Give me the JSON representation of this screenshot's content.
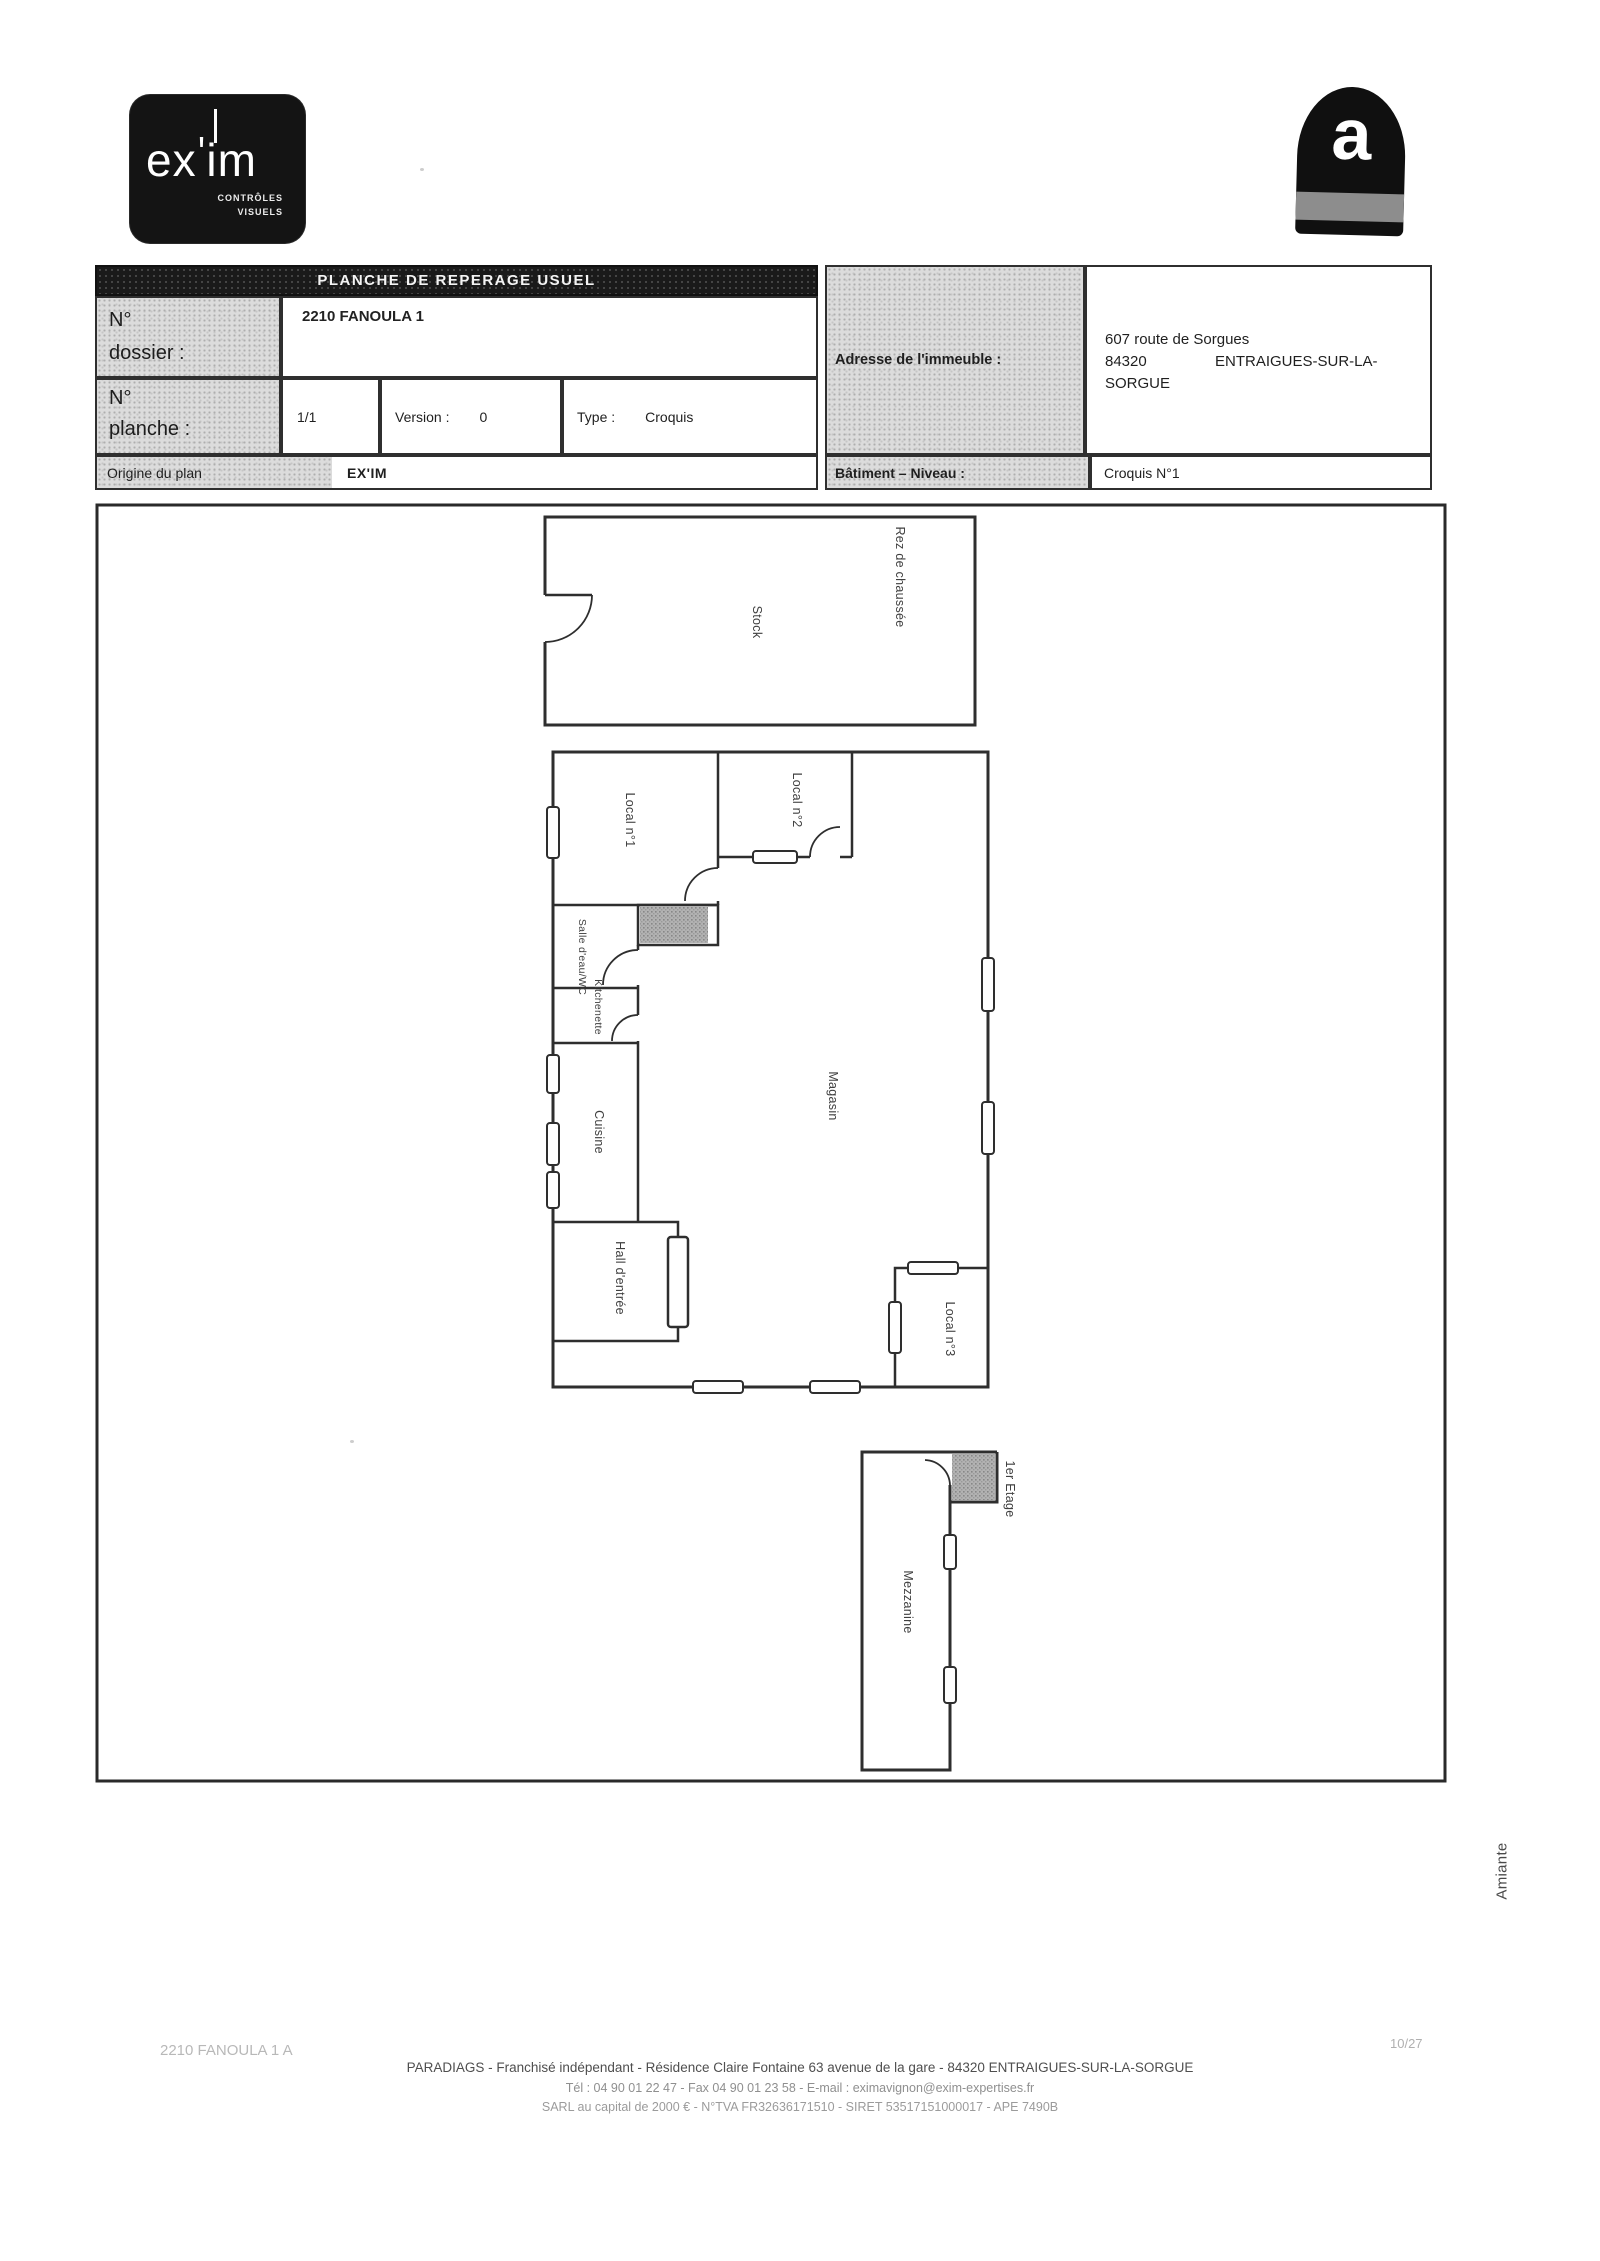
{
  "logo": {
    "part1": "ex",
    "apostrophe": "'",
    "part2": "im",
    "tagline1": "CONTRÔLES",
    "tagline2": "VISUELS"
  },
  "amiante_icon": {
    "letter": "a"
  },
  "header": {
    "title": "PLANCHE DE REPERAGE USUEL",
    "dossier_label1": "N°",
    "dossier_label2": "dossier :",
    "dossier_value": "2210 FANOULA 1",
    "planche_label1": "N°",
    "planche_label2": "planche :",
    "planche_value": "1/1",
    "version_label": "Version :",
    "version_value": "0",
    "type_label": "Type :",
    "type_value": "Croquis",
    "origine_label": "Origine du plan",
    "origine_value": "EX'IM",
    "adresse_label": "Adresse de l'immeuble :",
    "adresse_line1": "607 route de Sorgues",
    "adresse_line2_code": "84320",
    "adresse_line2_city": "ENTRAIGUES-SUR-LA-",
    "adresse_line3": "SORGUE",
    "batiment_label": "Bâtiment – Niveau :",
    "batiment_value": "Croquis N°1"
  },
  "plan": {
    "labels": {
      "stock": "Stock",
      "rez_de_chaussee": "Rez de chaussée",
      "local1": "Local n°1",
      "local2": "Local n°2",
      "salle_eau": "Salle d'eau/WC",
      "kitchenette": "Kitchenette",
      "cuisine": "Cuisine",
      "magasin": "Magasin",
      "hall": "Hall d'entrée",
      "local3": "Local n°3",
      "premier_etage": "1er Etage",
      "mezzanine": "Mezzanine"
    }
  },
  "side_label": "Amiante",
  "footer": {
    "ref": "2210 FANOULA 1 A",
    "page": "10/27",
    "line1": "PARADIAGS  - Franchisé indépendant - Résidence Claire Fontaine  63 avenue de la gare  - 84320 ENTRAIGUES-SUR-LA-SORGUE",
    "line2": "Tél : 04 90 01 22 47  - Fax 04 90 01 23 58  - E-mail : eximavignon@exim-expertises.fr",
    "line3": "SARL  au capital de 2000 €  - N°TVA FR32636171510  - SIRET 53517151000017  - APE 7490B"
  },
  "colors": {
    "ink": "#2e2e2e",
    "cell_gray": "#dcdcdc",
    "title_bar": "#1a1a1a",
    "hatch_gray": "#a9a9a9",
    "faded": "#b3b3b3"
  }
}
